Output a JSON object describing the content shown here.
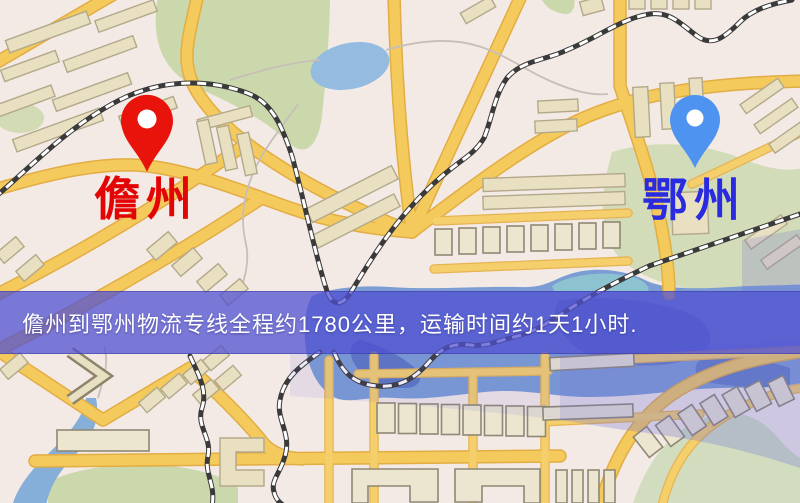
{
  "page": {
    "width": 800,
    "height": 503,
    "kind": "logistics route map"
  },
  "map": {
    "origin_marker": {
      "name": "儋州",
      "pin_color": "#e8140c",
      "label_color": "#e30505"
    },
    "destination_marker": {
      "name": "鄂州",
      "pin_color": "#4f93f0",
      "label_color": "#2a2ae0"
    },
    "info_banner": {
      "text": "儋州到鄂州物流专线全程约1780公里，运输时间约1天1小时.",
      "background": "#5050d2",
      "text_color": "#ffffff"
    },
    "route": {
      "distance": "约1780公里",
      "duration": "约1天1小时"
    },
    "palette": {
      "land": "#f3ece6",
      "park": "#ccd9ae",
      "water": "#7c9cd4",
      "road": "#f4ca5d",
      "railway": "#3a3a3a"
    }
  }
}
